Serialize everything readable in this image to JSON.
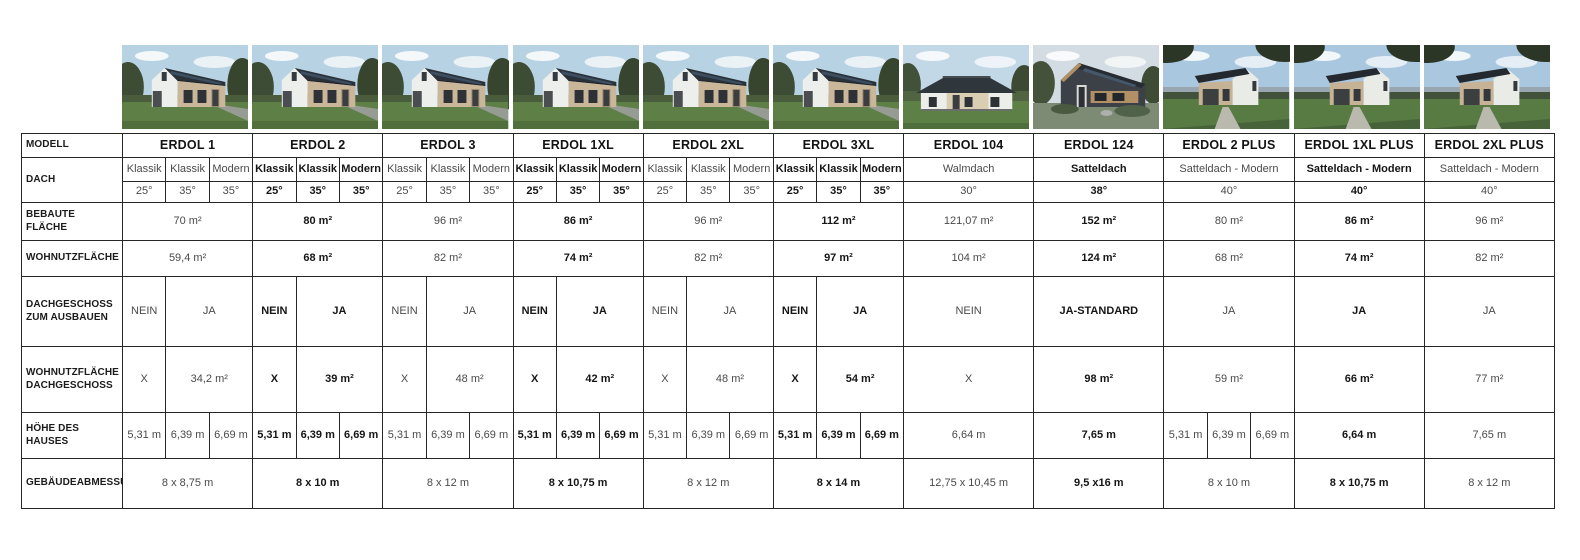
{
  "colors": {
    "table_border": "#262626",
    "text_regular": "#4a4a4a",
    "text_emphasis": "#161616"
  },
  "table": {
    "row_headers": {
      "modell": "MODELL",
      "dach": "DACH",
      "bebaute_flaeche": "BEBAUTE FLÄCHE",
      "wohnutzflaeche": "WOHNUTZFLÄCHE",
      "dachgeschoss": "DACHGESCHOSS ZUM AUSBAUEN",
      "wohnutzflaeche_dg": "WOHNUTZFLÄCHE DACHGESCHOSS",
      "hoehe": "HÖHE DES HAUSES",
      "gebaeude": "GEBÄUDEABMESSUNG"
    },
    "models": [
      {
        "name": "ERDOL 1",
        "emphasis": false,
        "photo": "gable-house",
        "dach_types": [
          "Klassik",
          "Klassik",
          "Modern"
        ],
        "dach_angles": [
          "25°",
          "35°",
          "35°"
        ],
        "bebaute_flaeche": "70 m²",
        "wohnutzflaeche": "59,4 m²",
        "dachgeschoss": [
          "NEIN",
          "JA"
        ],
        "wohnutzflaeche_dg": [
          "X",
          "34,2 m²"
        ],
        "hoehe": [
          "5,31 m",
          "6,39 m",
          "6,69 m"
        ],
        "gebaeude": "8 x 8,75 m"
      },
      {
        "name": "ERDOL 2",
        "emphasis": true,
        "photo": "gable-house",
        "dach_types": [
          "Klassik",
          "Klassik",
          "Modern"
        ],
        "dach_angles": [
          "25°",
          "35°",
          "35°"
        ],
        "bebaute_flaeche": "80 m²",
        "wohnutzflaeche": "68 m²",
        "dachgeschoss": [
          "NEIN",
          "JA"
        ],
        "wohnutzflaeche_dg": [
          "X",
          "39 m²"
        ],
        "hoehe": [
          "5,31 m",
          "6,39 m",
          "6,69 m"
        ],
        "gebaeude": "8 x 10 m"
      },
      {
        "name": "ERDOL 3",
        "emphasis": false,
        "photo": "gable-house",
        "dach_types": [
          "Klassik",
          "Klassik",
          "Modern"
        ],
        "dach_angles": [
          "25°",
          "35°",
          "35°"
        ],
        "bebaute_flaeche": "96 m²",
        "wohnutzflaeche": "82 m²",
        "dachgeschoss": [
          "NEIN",
          "JA"
        ],
        "wohnutzflaeche_dg": [
          "X",
          "48 m²"
        ],
        "hoehe": [
          "5,31 m",
          "6,39 m",
          "6,69 m"
        ],
        "gebaeude": "8 x 12 m"
      },
      {
        "name": "ERDOL 1XL",
        "emphasis": true,
        "photo": "gable-house",
        "dach_types": [
          "Klassik",
          "Klassik",
          "Modern"
        ],
        "dach_angles": [
          "25°",
          "35°",
          "35°"
        ],
        "bebaute_flaeche": "86 m²",
        "wohnutzflaeche": "74 m²",
        "dachgeschoss": [
          "NEIN",
          "JA"
        ],
        "wohnutzflaeche_dg": [
          "X",
          "42 m²"
        ],
        "hoehe": [
          "5,31 m",
          "6,39 m",
          "6,69 m"
        ],
        "gebaeude": "8 x 10,75 m"
      },
      {
        "name": "ERDOL 2XL",
        "emphasis": false,
        "photo": "gable-house",
        "dach_types": [
          "Klassik",
          "Klassik",
          "Modern"
        ],
        "dach_angles": [
          "25°",
          "35°",
          "35°"
        ],
        "bebaute_flaeche": "96 m²",
        "wohnutzflaeche": "82 m²",
        "dachgeschoss": [
          "NEIN",
          "JA"
        ],
        "wohnutzflaeche_dg": [
          "X",
          "48 m²"
        ],
        "hoehe": [
          "5,31 m",
          "6,39 m",
          "6,69 m"
        ],
        "gebaeude": "8 x 12 m"
      },
      {
        "name": "ERDOL 3XL",
        "emphasis": true,
        "photo": "gable-house",
        "dach_types": [
          "Klassik",
          "Klassik",
          "Modern"
        ],
        "dach_angles": [
          "25°",
          "35°",
          "35°"
        ],
        "bebaute_flaeche": "112 m²",
        "wohnutzflaeche": "97 m²",
        "dachgeschoss": [
          "NEIN",
          "JA"
        ],
        "wohnutzflaeche_dg": [
          "X",
          "54 m²"
        ],
        "hoehe": [
          "5,31 m",
          "6,39 m",
          "6,69 m"
        ],
        "gebaeude": "8 x 14 m"
      },
      {
        "name": "ERDOL 104",
        "emphasis": false,
        "photo": "bungalow-house",
        "dach_types": [
          "Walmdach"
        ],
        "dach_angles": [
          "30°"
        ],
        "bebaute_flaeche": "121,07 m²",
        "wohnutzflaeche": "104 m²",
        "dachgeschoss": [
          "NEIN"
        ],
        "wohnutzflaeche_dg": [
          "X"
        ],
        "hoehe": [
          "6,64 m"
        ],
        "gebaeude": "12,75 x 10,45 m"
      },
      {
        "name": "ERDOL 124",
        "emphasis": true,
        "photo": "modern-dark-house",
        "dach_types": [
          "Satteldach"
        ],
        "dach_angles": [
          "38°"
        ],
        "bebaute_flaeche": "152 m²",
        "wohnutzflaeche": "124 m²",
        "dachgeschoss": [
          "JA-STANDARD"
        ],
        "wohnutzflaeche_dg": [
          "98 m²"
        ],
        "hoehe": [
          "7,65 m"
        ],
        "gebaeude": "9,5 x16 m"
      },
      {
        "name": "ERDOL 2 PLUS",
        "emphasis": false,
        "photo": "plus-gable-house",
        "dach_types": [
          "Satteldach - Modern"
        ],
        "dach_angles": [
          "40°"
        ],
        "bebaute_flaeche": "80 m²",
        "wohnutzflaeche": "68 m²",
        "dachgeschoss": [
          "JA"
        ],
        "wohnutzflaeche_dg": [
          "59 m²"
        ],
        "hoehe": [
          "5,31 m",
          "6,39 m",
          "6,69 m"
        ],
        "gebaeude": "8 x 10 m"
      },
      {
        "name": "ERDOL 1XL PLUS",
        "emphasis": true,
        "photo": "plus-gable-house",
        "dach_types": [
          "Satteldach - Modern"
        ],
        "dach_angles": [
          "40°"
        ],
        "bebaute_flaeche": "86 m²",
        "wohnutzflaeche": "74 m²",
        "dachgeschoss": [
          "JA"
        ],
        "wohnutzflaeche_dg": [
          "66 m²"
        ],
        "hoehe": [
          "6,64 m"
        ],
        "gebaeude": "8 x 10,75 m"
      },
      {
        "name": "ERDOL 2XL PLUS",
        "emphasis": false,
        "photo": "plus-gable-house",
        "dach_types": [
          "Satteldach - Modern"
        ],
        "dach_angles": [
          "40°"
        ],
        "bebaute_flaeche": "96 m²",
        "wohnutzflaeche": "82 m²",
        "dachgeschoss": [
          "JA"
        ],
        "wohnutzflaeche_dg": [
          "77 m²"
        ],
        "hoehe": [
          "7,65 m"
        ],
        "gebaeude": "8 x 12 m"
      }
    ]
  }
}
